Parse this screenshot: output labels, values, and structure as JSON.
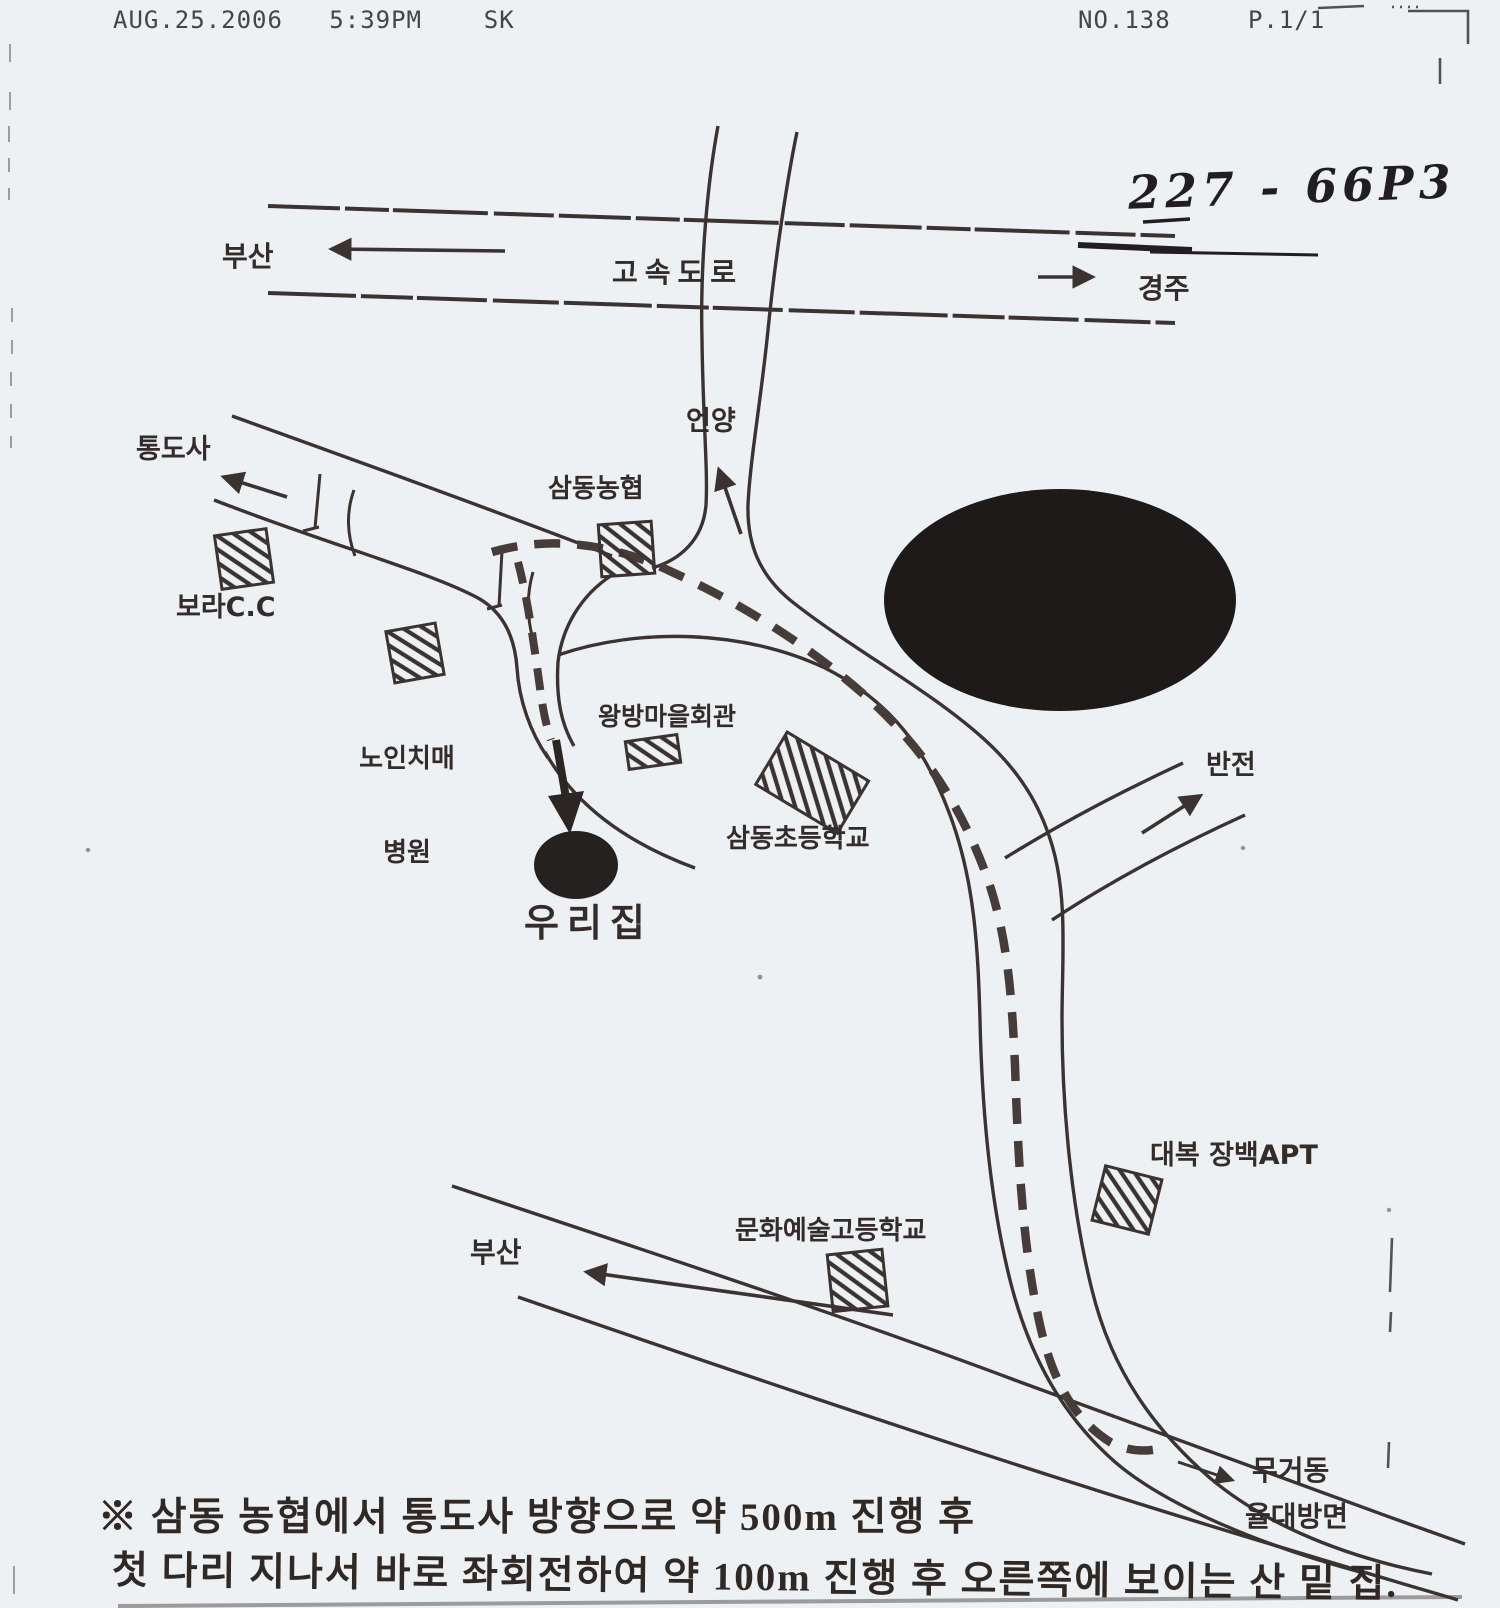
{
  "fax_header": {
    "left": "AUG.25.2006   5:39PM    SK",
    "right": "NO.138     P.1/1"
  },
  "handwritten": {
    "number": "227 - 66P3"
  },
  "map": {
    "highway_label": "고속도로",
    "busan_top": "부산",
    "gyeongju": "경주",
    "unyang": "언양",
    "tongdosa": "통도사",
    "bora_cc": "보라C.C",
    "samdong_nonghyup": "삼동농협",
    "noin_line1": "노인치매",
    "noin_line2": "병원",
    "wangbang": "왕방마을회관",
    "samdong_elementary": "삼동초등학교",
    "our_house": "우리집",
    "bancheon": "반전",
    "daebok_apt": "대복 장백APT",
    "munhwa_highschool": "문화예술고등학교",
    "busan_bottom": "부산",
    "mugeo_dong": "무거동",
    "yuldae_direction": "율대방면"
  },
  "note": {
    "line1": "※ 삼동 농협에서 통도사 방향으로 약 500m 진행 후",
    "line2": "첫 다리 지나서 바로 좌회전하여 약 100m 진행 후 오른쪽에 보이는 산 밑 집."
  },
  "colors": {
    "paper": "#eef1f3",
    "ink": "#3b3331",
    "route": "#463d3a",
    "fill_black": "#1d1a19"
  }
}
